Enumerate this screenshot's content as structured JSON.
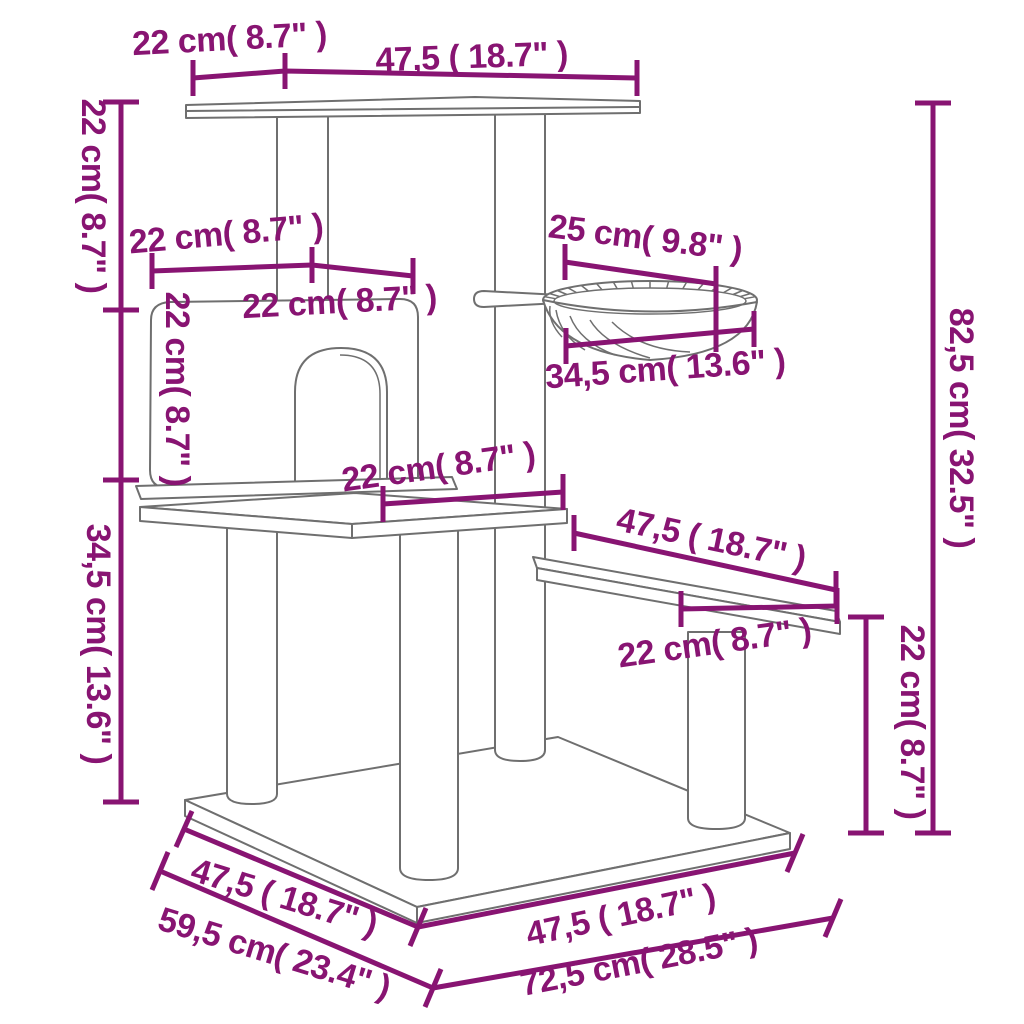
{
  "diagram": {
    "type": "product-dimension-line-drawing",
    "subject": "cat tree with condo house, hammock basket, step platform and base board",
    "colors": {
      "dimension_accent": "#881472",
      "line_art": "#6f6f6f",
      "background": "#ffffff"
    },
    "units": {
      "metric": "cm",
      "imperial": "inches"
    },
    "labels": {
      "top_depth": "22 cm( 8.7\" )",
      "top_width": "47,5 ( 18.7\" )",
      "upper_height": "22 cm( 8.7\" )",
      "house_top_depth": "22 cm( 8.7\" )",
      "house_top_width": "22 cm( 8.7\" )",
      "house_front_height": "22 cm( 8.7\" )",
      "hammock_depth": "25 cm( 9.8\" )",
      "hammock_width": "34,5 cm( 13.6\" )",
      "middle_height": "34,5 cm( 13.6\" )",
      "middle_platform_width": "22 cm( 8.7\" )",
      "step_platform_width": "47,5 ( 18.7\" )",
      "step_platform_depth": "22 cm( 8.7\" )",
      "step_height": "22 cm( 8.7\" )",
      "total_height": "82,5 cm( 32.5\" )",
      "base_front_left_width": "47,5 ( 18.7\" )",
      "base_left_depth": "59,5 cm( 23.4\" )",
      "base_front_right_width": "47,5 ( 18.7\" )",
      "base_right_width": "72,5 cm( 28.5\" )"
    }
  }
}
